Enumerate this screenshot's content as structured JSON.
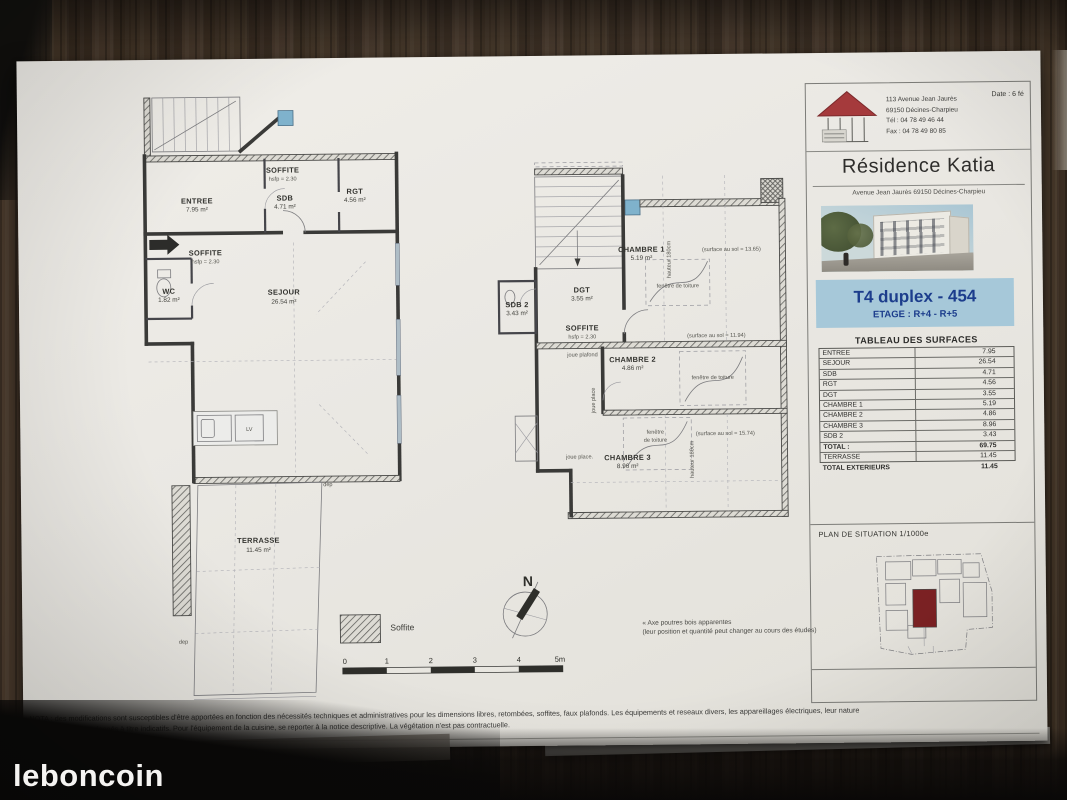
{
  "watermark": {
    "brand": "leboncoin"
  },
  "paper": {
    "nota_line1": "NOTA : des modifications sont susceptibles d'être apportées en fonction des nécessités techniques et administratives pour les dimensions libres, retombées, soffites, faux plafonds. Les équipements et reseaux divers, les appareillages électriques, leur nature",
    "nota_line2": "et leur nombre sont donnés à titre indicatifs. Pour l'équipement de la cuisine, se reporter à la notice descriptive. La végétation n'est pas contractuelle.",
    "date_label": "Date : 6 fé"
  },
  "title_block": {
    "address_lines": [
      "113 Avenue Jean Jaurès",
      "69150 Décines-Charpieu",
      "Tél : 04 78 49 46 44",
      "Fax : 04 78 49 80 85"
    ],
    "residence_name": "Résidence Katia",
    "residence_address": "Avenue Jean Jaurès 69150 Décines-Charpieu",
    "unit": {
      "title": "T4 duplex - 454",
      "floor": "ETAGE : R+4 - R+5",
      "band_color": "#a6c8d9",
      "text_color": "#1c3d8c"
    },
    "surfaces": {
      "title": "TABLEAU DES SURFACES",
      "rows": [
        {
          "label": "ENTREE",
          "value": "7.95"
        },
        {
          "label": "SEJOUR",
          "value": "26.54"
        },
        {
          "label": "SDB",
          "value": "4.71"
        },
        {
          "label": "RGT",
          "value": "4.56"
        },
        {
          "label": "DGT",
          "value": "3.55"
        },
        {
          "label": "CHAMBRE 1",
          "value": "5.19"
        },
        {
          "label": "CHAMBRE 2",
          "value": "4.86"
        },
        {
          "label": "CHAMBRE 3",
          "value": "8.96"
        },
        {
          "label": "SDB 2",
          "value": "3.43"
        },
        {
          "label": "TOTAL :",
          "value": "69.75"
        },
        {
          "label": "TERRASSE",
          "value": "11.45"
        },
        {
          "label": "TOTAL EXTERIEURS",
          "value": "11.45"
        }
      ]
    },
    "situation": {
      "title": "PLAN DE SITUATION 1/1000e",
      "building_color": "#7b2123"
    }
  },
  "plans": {
    "lower": {
      "entree": {
        "name": "ENTREE",
        "area": "7.95 m²"
      },
      "soffite_top": {
        "name": "SOFFITE",
        "sub": "hsfp = 2.30"
      },
      "soffite_left": {
        "name": "SOFFITE",
        "sub": "hsfp = 2.30"
      },
      "sdb": {
        "name": "SDB",
        "area": "4.71 m²"
      },
      "rgt": {
        "name": "RGT",
        "area": "4.56 m²"
      },
      "sejour": {
        "name": "SEJOUR",
        "area": "26.54 m²"
      },
      "wc": {
        "name": "WC",
        "area": "1.82 m²"
      },
      "lv": "LV",
      "terrasse": {
        "name": "TERRASSE",
        "area": "11.45 m²"
      },
      "dep1": "dep",
      "dep2": "dep"
    },
    "upper": {
      "chambre1": {
        "name": "CHAMBRE 1",
        "area": "5.19 m²",
        "note": "(surface au sol = 13.65)"
      },
      "dgt": {
        "name": "DGT",
        "area": "3.55 m²"
      },
      "sdb2": {
        "name": "SDB 2",
        "area": "3.43 m²"
      },
      "soffite": {
        "name": "SOFFITE",
        "sub": "hsfp = 2.30",
        "note": "joue plafond"
      },
      "chambre2": {
        "name": "CHAMBRE 2",
        "area": "4.86 m²",
        "note": "(surface au sol = 11.94)"
      },
      "chambre3": {
        "name": "CHAMBRE 3",
        "area": "8.96 m²",
        "note": "(surface au sol = 15.74)"
      },
      "skylight1": "fenêtre de toiture",
      "skylight2": "fenêtre de toiture",
      "skylight3a": "fenêtre",
      "skylight3b": "de toiture",
      "joue_h": "joue place.",
      "joue_v": "joue place",
      "hauteur1": "hauteur 180cm",
      "hauteur2": "hauteur 180cm"
    }
  },
  "legend": {
    "soffite_label": "Soffite",
    "north_label": "N",
    "scale_ticks": [
      "0",
      "1",
      "2",
      "3",
      "4",
      "5m"
    ],
    "beam_note_line1": "« Axe poutres bois apparentes",
    "beam_note_line2": "(leur position et quantité peut changer au cours des études)"
  }
}
